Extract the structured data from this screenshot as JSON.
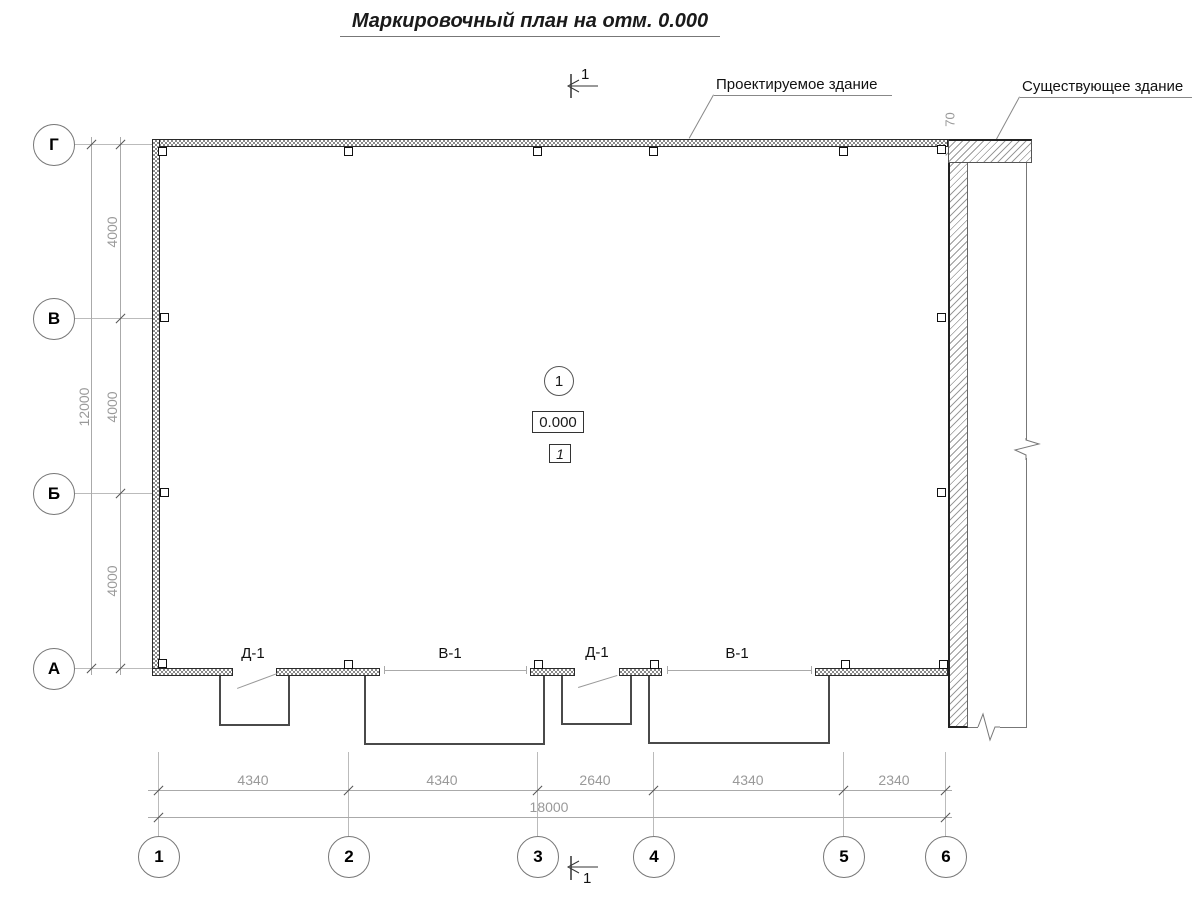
{
  "title": "Маркировочный план на отм. 0.000",
  "callouts": {
    "designed": "Проектируемое здание",
    "existing": "Существующее здание"
  },
  "section_mark": {
    "top": "1",
    "bottom": "1"
  },
  "joint_dimension": "70",
  "markers": {
    "axis_bubble": "1",
    "elevation": "0.000",
    "room_number": "1"
  },
  "opening_labels": {
    "d1_left": "Д-1",
    "v1_left": "В-1",
    "d1_right": "Д-1",
    "v1_right": "В-1"
  },
  "row_axes": [
    "Г",
    "В",
    "Б",
    "А"
  ],
  "col_axes": [
    "1",
    "2",
    "3",
    "4",
    "5",
    "6"
  ],
  "dims": {
    "v_segments": [
      "4000",
      "4000",
      "4000"
    ],
    "v_total": "12000",
    "h_segments": [
      "4340",
      "4340",
      "2640",
      "4340",
      "2340"
    ],
    "h_total": "18000"
  },
  "colors": {
    "dim_gray": "#999999",
    "ink": "#1a1a1a",
    "hatch_gray": "#9a9a9a"
  }
}
